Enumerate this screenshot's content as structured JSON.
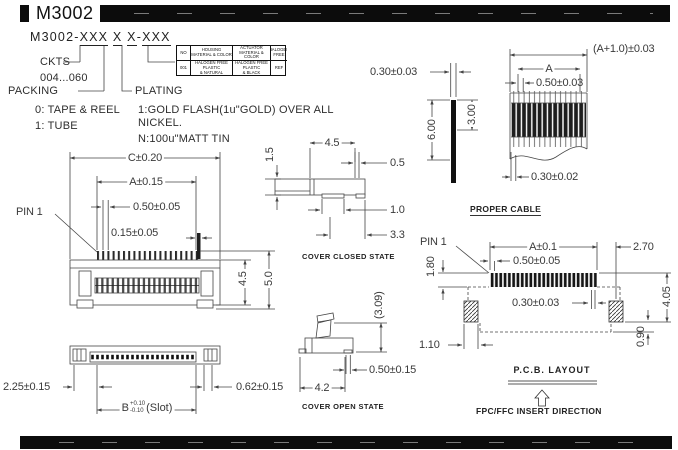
{
  "header": {
    "title": "M3002"
  },
  "part_number": {
    "prefix": "M3002-",
    "ckts_field": "XXX",
    "packing_field": "X",
    "plating_field": "X",
    "dash": "-",
    "suffix_field": "XXX",
    "ckts_label": "CKTS",
    "ckts_range": "004...060",
    "packing_label": "PACKING",
    "packing_opt_0": "0: TAPE & REEL",
    "packing_opt_1": "1: TUBE",
    "plating_label": "PLATING",
    "plating_opt_1": "1:GOLD FLASH(1u\"GOLD) OVER ALL",
    "plating_opt_1b": "NICKEL.",
    "plating_opt_n": "N:100u\"MATT TIN"
  },
  "materials_table": {
    "col0_header": "NO",
    "col0_value": "001",
    "housing_header": "HOUSING\nMATERIAL & COLOR",
    "housing_value": "HALOGEN FREE PLASTIC\n& NATURAL",
    "actuator_header": "ACTUATOR\nMATERIAL & COLOR",
    "actuator_value": "HALOGEN FREE PLASTIC\n& BLACK",
    "halogen_header": "HALOGEN\nFREE",
    "halogen_value": "REF"
  },
  "front_view": {
    "dim_c": "C±0.20",
    "dim_a": "A±0.15",
    "dim_pitch": "0.50±0.05",
    "dim_pin_width": "0.15±0.05",
    "pin1": "PIN 1",
    "dim_body_height": "4.5",
    "dim_total_height": "5.0"
  },
  "bottom_view": {
    "dim_left": "2.25±0.15",
    "dim_right": "0.62±0.15",
    "slot_letter": "B",
    "slot_tol_plus": "+0.10",
    "slot_tol_minus": "-0.10",
    "slot_suffix": "(Slot)"
  },
  "cover_closed_view": {
    "dim_height": "1.5",
    "dim_depth": "4.5",
    "dim_tail": "0.5",
    "dim_foot": "1.0",
    "dim_span": "3.3",
    "caption": "COVER CLOSED STATE"
  },
  "cover_open_view": {
    "dim_open_height": "(3.09)",
    "dim_foot": "0.50±0.15",
    "dim_width": "4.2",
    "caption": "COVER OPEN STATE"
  },
  "cable_view": {
    "dim_thickness": "0.30±0.03",
    "dim_length": "6.00",
    "dim_exposed": "3.00",
    "dim_overall": "(A+1.0)±0.03",
    "dim_a": "A",
    "dim_pitch": "0.50±0.03",
    "dim_conductor": "0.30±0.02",
    "caption": "PROPER CABLE"
  },
  "pcb_view": {
    "pin1": "PIN 1",
    "dim_a": "A±0.1",
    "dim_end": "2.70",
    "dim_pitch": "0.50±0.05",
    "dim_pad_length": "1.80",
    "dim_pad_width": "0.30±0.03",
    "dim_height": "4.05",
    "dim_anchor_offset": "0.90",
    "dim_anchor_width": "1.10",
    "caption": "P.C.B. LAYOUT",
    "insert_direction": "FPC/FFC INSERT DIRECTION"
  },
  "colors": {
    "line": "#454545",
    "ink": "#1f1f1f",
    "bar": "#0c0c0c"
  }
}
